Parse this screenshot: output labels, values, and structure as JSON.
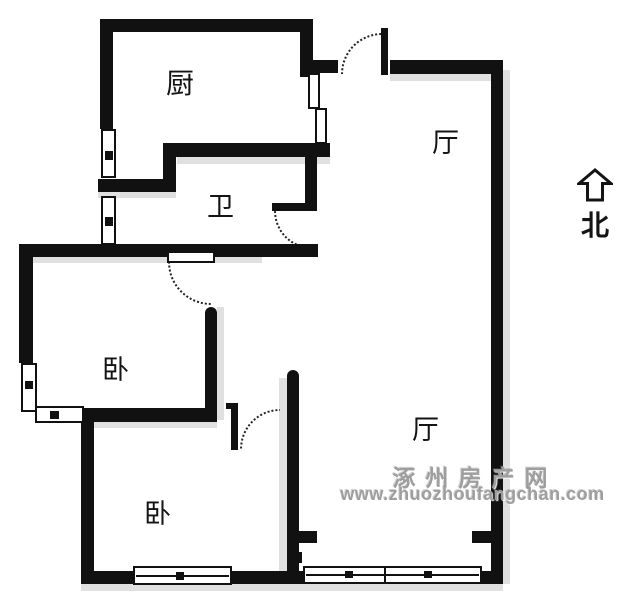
{
  "rooms": {
    "kitchen": "厨",
    "bath": "卫",
    "hall_upper": "厅",
    "hall_lower": "厅",
    "bedroom_upper": "卧",
    "bedroom_lower": "卧"
  },
  "compass": {
    "north_label": "北"
  },
  "watermark": {
    "site_name": "涿州房产网",
    "site_url": "www.zhuozhoufangchan.com"
  },
  "colors": {
    "wall": "#111111",
    "shadow": "#e0e0e0",
    "watermark_gray": "#9e9e9e",
    "background": "#ffffff"
  }
}
